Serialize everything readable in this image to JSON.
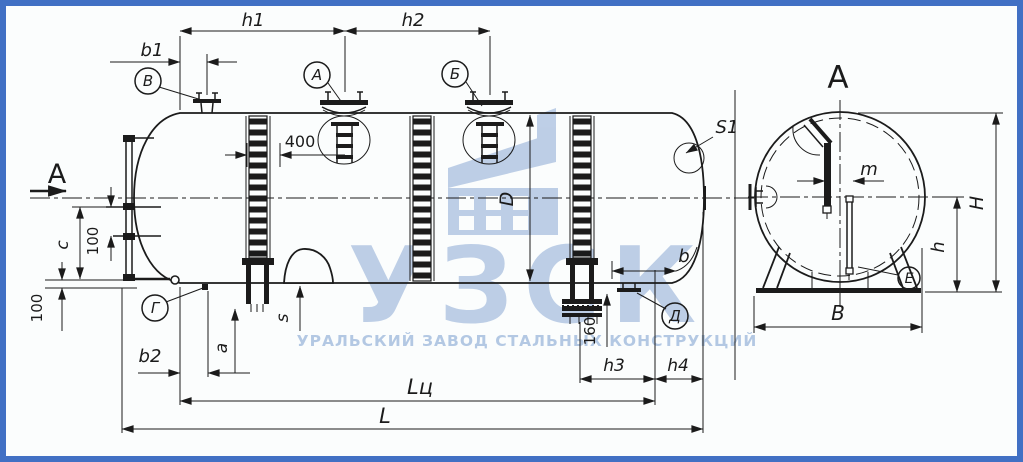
{
  "page": {
    "background": "#fbfdfd",
    "frame_color": "#4170c4",
    "ink": "#1b1b1b"
  },
  "watermark": {
    "logo": "УЗСК",
    "tagline": "УРАЛЬСКИЙ ЗАВОД СТАЛЬНЫХ КОНСТРУКЦИЙ",
    "color": "#b7cae4"
  },
  "main_view": {
    "section_arrow_label": "А",
    "callouts": {
      "v": "В",
      "a": "А",
      "b": "Б",
      "g": "Г",
      "d": "Д"
    },
    "dims": {
      "h1": "h1",
      "h2": "h2",
      "b1": "b1",
      "hatch_offset": "400",
      "c": "c",
      "gauge_spacing": "100",
      "ground_clearance": "100",
      "b2": "b2",
      "a": "a",
      "s": "s",
      "shell_diameter": "D",
      "head_thickness": "S1",
      "b": "b",
      "drain_height": "160",
      "h3": "h3",
      "h4": "h4",
      "cylinder_length": "Lц",
      "overall_length": "L"
    }
  },
  "section_view": {
    "title": "А",
    "callouts": {
      "e": "Е"
    },
    "dims": {
      "m": "m",
      "overall_height": "H",
      "saddle_height": "h",
      "base_width": "В"
    }
  }
}
